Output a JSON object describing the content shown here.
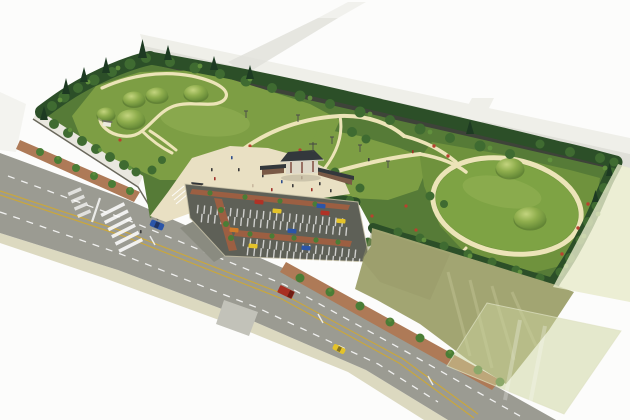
{
  "scene": {
    "description": "Aerial bird's-eye architectural watercolor rendering of a landscaped burial-mound (tumuli) park with winding footpaths, an entrance plaza with a traditional tiled-roof gate, a striped parking lot with cars, perimeter roads with traffic, street trees, and an adjacent vacant khaki field on white paper background",
    "view": "isometric-style perspective from the south-west",
    "text_labels": []
  },
  "colors": {
    "bg": "#fcfcfb",
    "faint_band": "#e0e0d9",
    "faint_band_light": "#efefe9",
    "road": "#9b9b92",
    "road_stub": "#c2c2b9",
    "sidewalk_outer": "#dcd9c0",
    "sidewalk_park": "#ae7a57",
    "lane_yellow": "#c9a73d",
    "park_base": "#567b37",
    "lawn": "#7d9e44",
    "lawn_right": "#7ea344",
    "lawn_backing": "#6f923d",
    "lawn_light": "#a6c065",
    "path": "#ece4b8",
    "wall_face": "#e9e7df",
    "wall_dark": "#3e4339",
    "wall_top": "#cfcec5",
    "tree_dark": "#2c4f28",
    "tree_mid": "#3f6b31",
    "tree_light": "#62923e",
    "conifer": "#1d3a22",
    "street_tree": "#4a7d36",
    "flower": "#b8422f",
    "plaza": "#e9e0c3",
    "gate_roof": "#33383c",
    "gate_wall": "#ded8c8",
    "side_wall": "#7a5a46",
    "booth": "#50443c",
    "parking": "#5e6057",
    "parking_strip": "#9c5f42",
    "field": "#a2a572",
    "field_light": "#c0c293",
    "overlay_green": "#ccd39e",
    "overlay_strip": "#e7eacb",
    "car_blue": "#2b55a8",
    "car_yellow": "#e4c32a",
    "car_red": "#b03226",
    "car_orange": "#cf7a2a",
    "truck_red": "#a82f22",
    "people_dark": "#3a3a3a",
    "people_red": "#a03028",
    "people_blue": "#2f4e8c",
    "people_tan": "#c9b9a0"
  },
  "inventory": {
    "burial_mounds_left_lawn": 5,
    "burial_mounds_right_lawn": 2,
    "small_pavilion_on_left_lawn": 1,
    "entrance_gate": "dark tiled-roof traditional gate with flanking walls and flag pole",
    "entrance_booth": 1,
    "parking_stall_rows": 4,
    "parked_cars": 9,
    "vehicles_on_road": [
      "blue car",
      "red truck",
      "yellow taxi"
    ],
    "crosswalk": "zebra crossing at park entrance",
    "plaza_visitors": "scattered pedestrian figures",
    "adjacent_vacant_field": true,
    "translucent_overlay_sheet": "pale green sheet over bottom-right corner"
  }
}
